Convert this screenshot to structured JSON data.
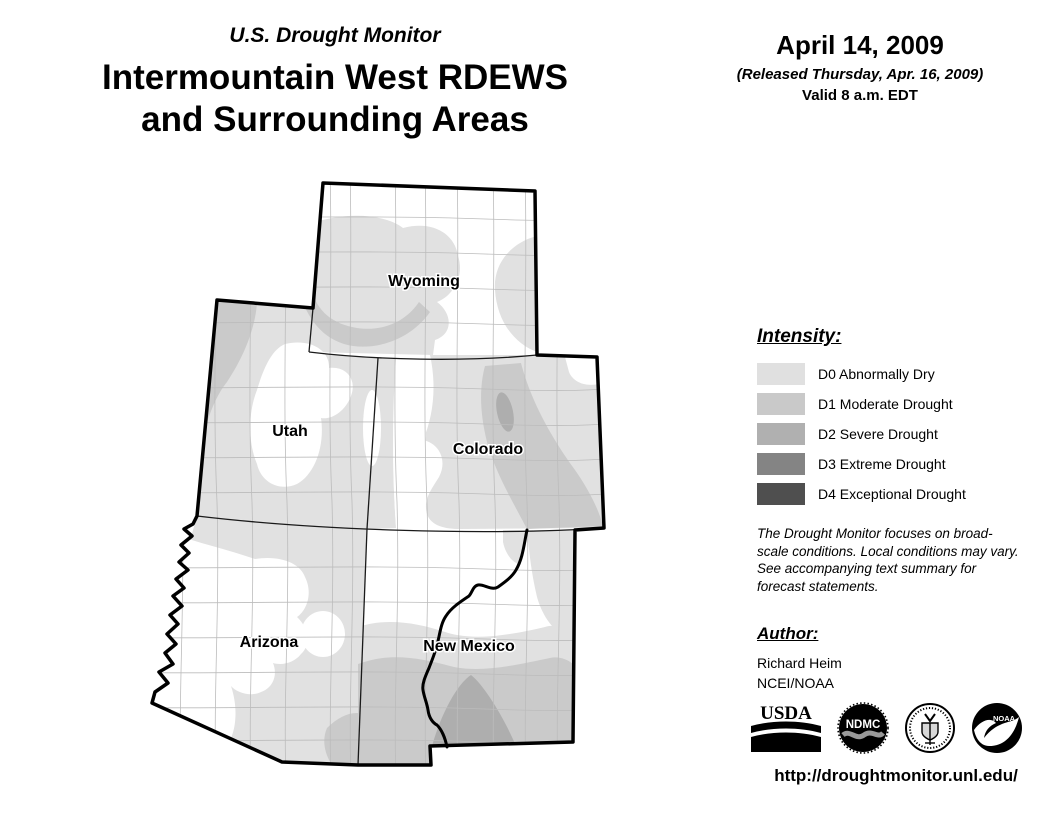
{
  "header": {
    "kicker": "U.S. Drought Monitor",
    "title_line1": "Intermountain West RDEWS",
    "title_line2": "and Surrounding Areas"
  },
  "date_block": {
    "date": "April 14, 2009",
    "released": "(Released Thursday, Apr. 16, 2009)",
    "valid": "Valid 8 a.m. EDT"
  },
  "map": {
    "states": [
      {
        "id": "wyoming",
        "label": "Wyoming"
      },
      {
        "id": "utah",
        "label": "Utah"
      },
      {
        "id": "colorado",
        "label": "Colorado"
      },
      {
        "id": "arizona",
        "label": "Arizona"
      },
      {
        "id": "new-mexico",
        "label": "New Mexico"
      }
    ]
  },
  "legend": {
    "heading": "Intensity:",
    "items": [
      {
        "label": "D0 Abnormally Dry",
        "color": "#e0e0e0"
      },
      {
        "label": "D1 Moderate Drought",
        "color": "#c9c9c9"
      },
      {
        "label": "D2 Severe Drought",
        "color": "#b0b0b0"
      },
      {
        "label": "D3 Extreme Drought",
        "color": "#848484"
      },
      {
        "label": "D4 Exceptional Drought",
        "color": "#4f4f4f"
      }
    ]
  },
  "disclaimer": "The Drought Monitor focuses on broad-scale conditions. Local conditions may vary. See accompanying text summary for forecast statements.",
  "author": {
    "heading": "Author:",
    "name": "Richard Heim",
    "org": "NCEI/NOAA"
  },
  "logos": [
    {
      "name": "usda",
      "text": "USDA"
    },
    {
      "name": "ndmc",
      "text": "NDMC"
    },
    {
      "name": "commerce-seal",
      "text": ""
    },
    {
      "name": "noaa",
      "text": "NOAA"
    }
  ],
  "url": "http://droughtmonitor.unl.edu/",
  "colors": {
    "d0": "#e1e1e1",
    "d1": "#cacaca",
    "d2": "#aeaeae",
    "d3": "#848484",
    "d4": "#4f4f4f",
    "border": "#000000",
    "county_line": "#bcbcbc"
  }
}
